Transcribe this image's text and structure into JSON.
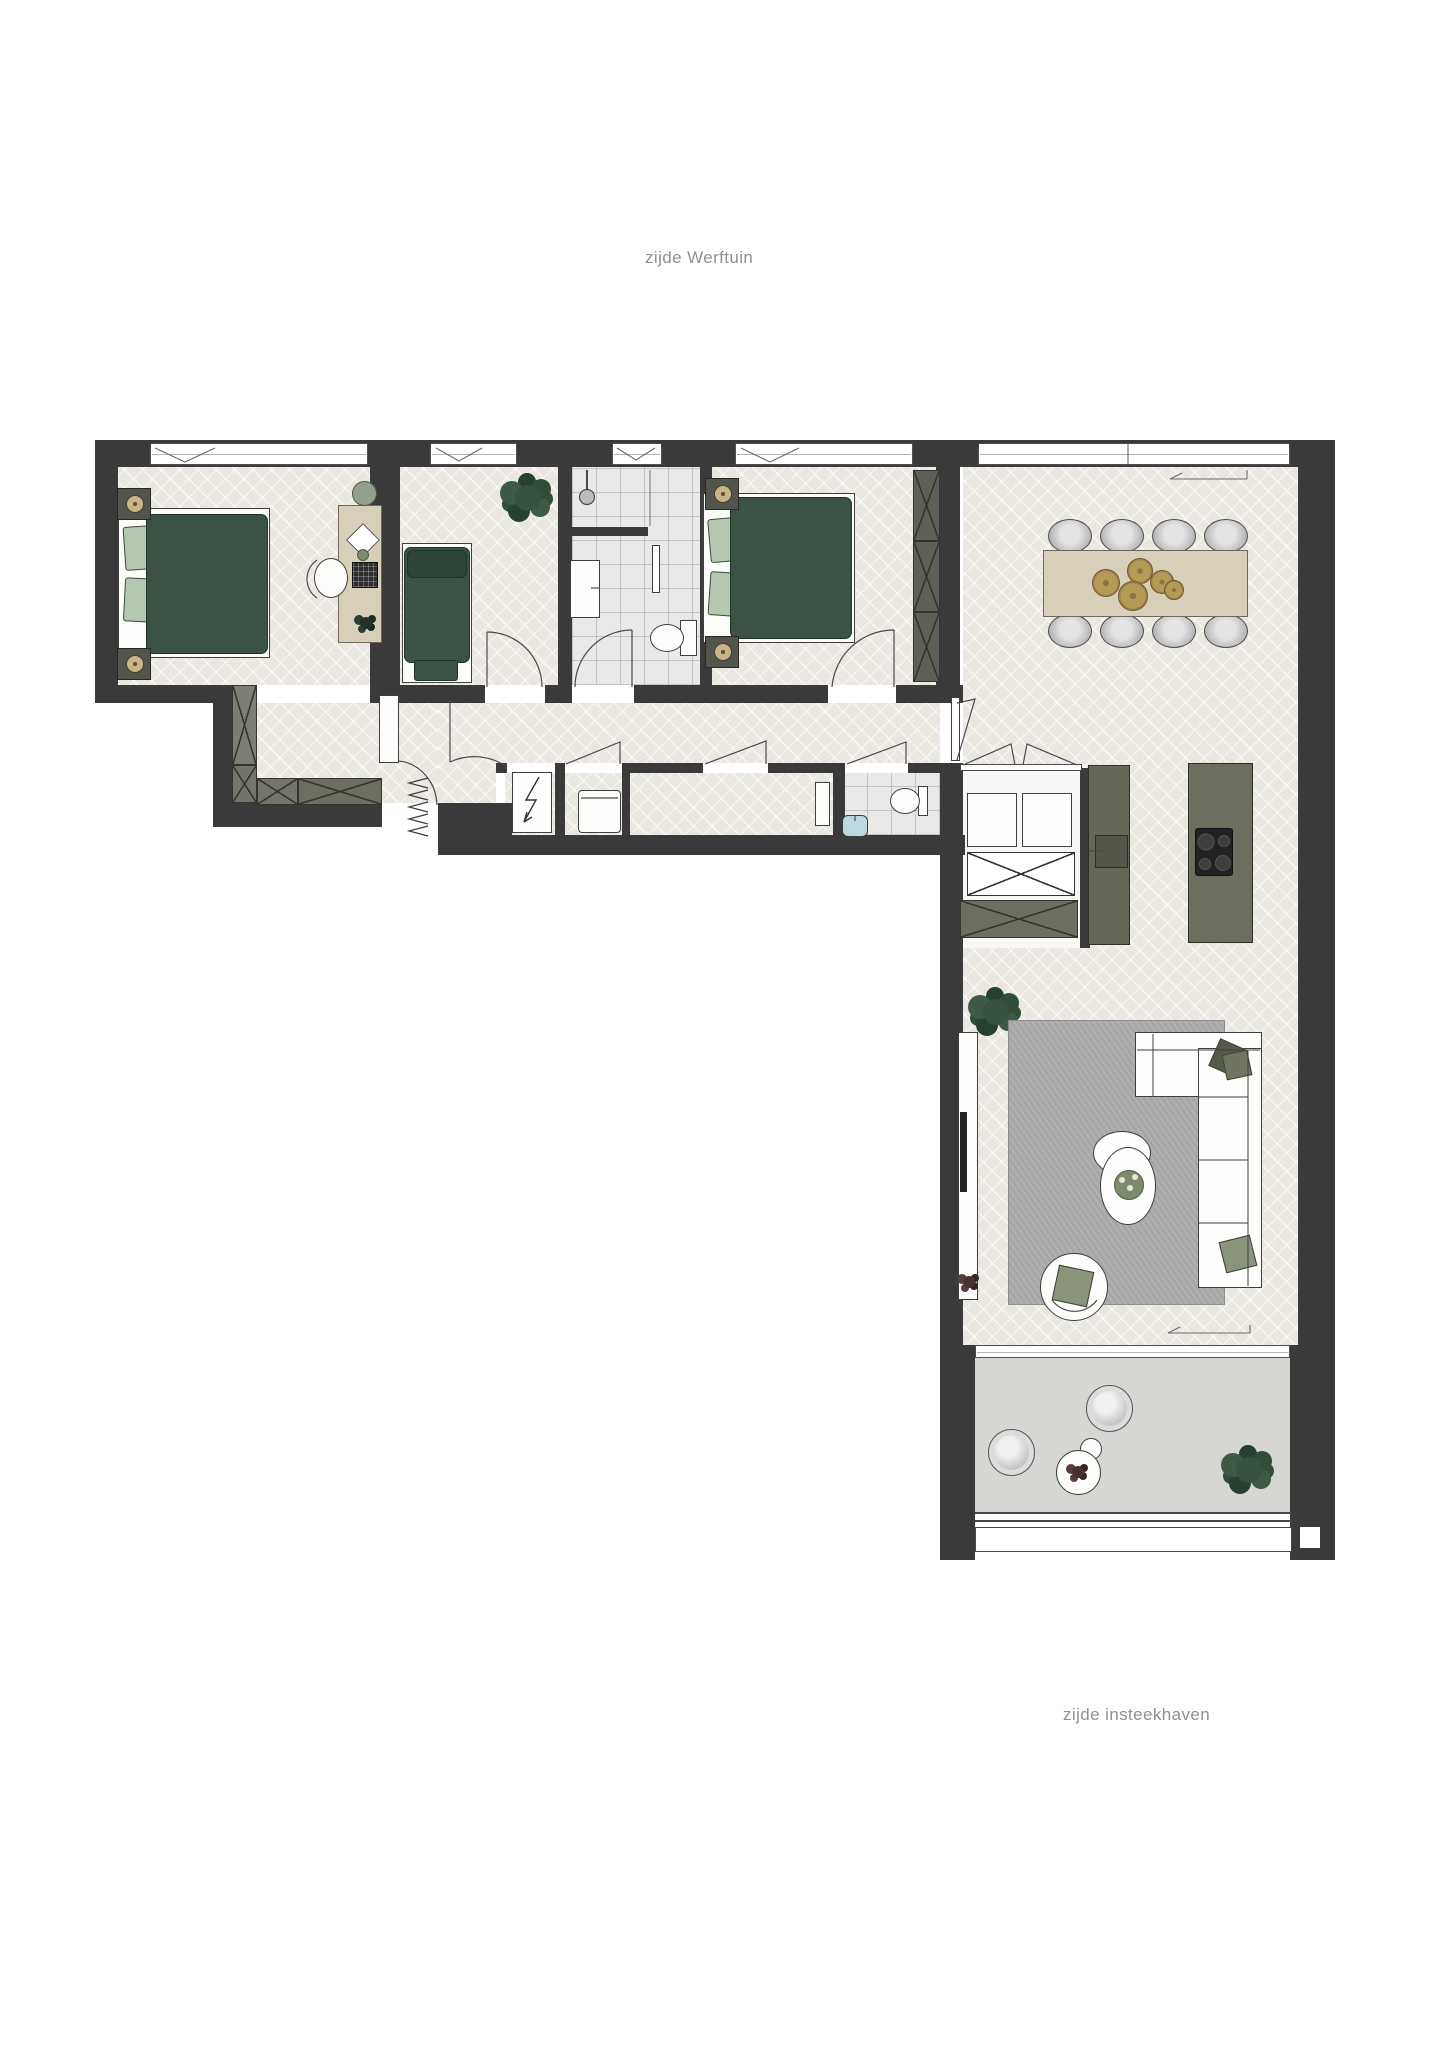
{
  "labels": {
    "top": "zijde Werftuin",
    "bottom": "zijde insteekhaven"
  },
  "palette": {
    "wall": "#3a3a3a",
    "floor": "#eae7e0",
    "tile": "#e9e9e7",
    "balcony": "#d6d6d3",
    "accent_green": "#3c5244",
    "pillow_green": "#b5c7b0",
    "olive": "#6c6e60",
    "olive_dark": "#5e6057",
    "wood": "#d8cfba",
    "rug": "#a6a6a6",
    "gold": "#ac8f51",
    "line": "#454545",
    "text_gray": "#909090",
    "white": "#ffffff"
  }
}
